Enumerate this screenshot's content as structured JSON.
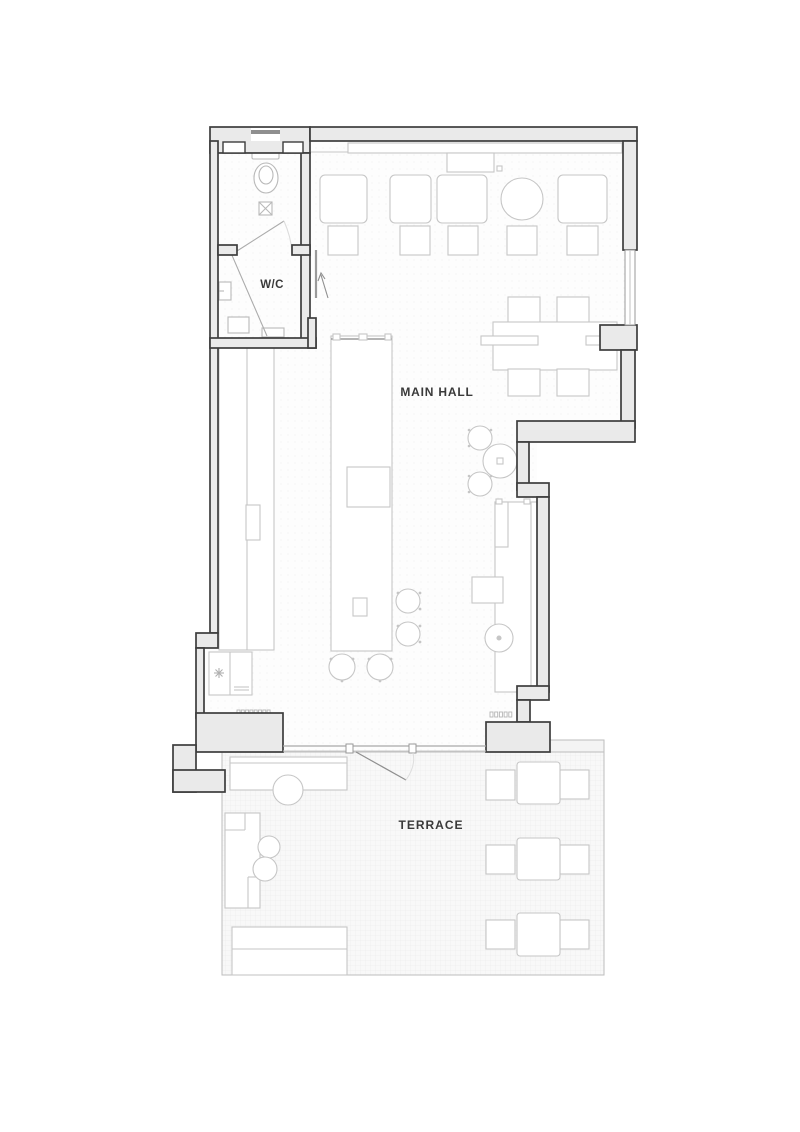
{
  "labels": {
    "wc": "W/C",
    "main_hall": "MAIN HALL",
    "terrace": "TERRACE"
  },
  "colors": {
    "wall_line": "#3d3d3d",
    "wall_fill": "#eaeaea",
    "furniture_line": "#c6c6c6",
    "fixture_line": "#b9b9b9",
    "glass_line": "#a8a8a8",
    "floor": "#fdfdfd",
    "terrace_floor": "#f8f8f8",
    "text": "#3a3a3a"
  },
  "legend": {
    "wc_room": "toilet, floor drain, wash basin, door swings",
    "main_hall": "banquette bench, 5 wall tables with chairs, communal table with 4 chairs, long bar island with 4 stools, back counter, cooler, 2 round tables with stools, wall counter with round and square tables",
    "terrace": "service counter with round table, L-shaped sofa with 2 round tables, planter, 3 tables each with 2 chairs, entrance door swing"
  }
}
